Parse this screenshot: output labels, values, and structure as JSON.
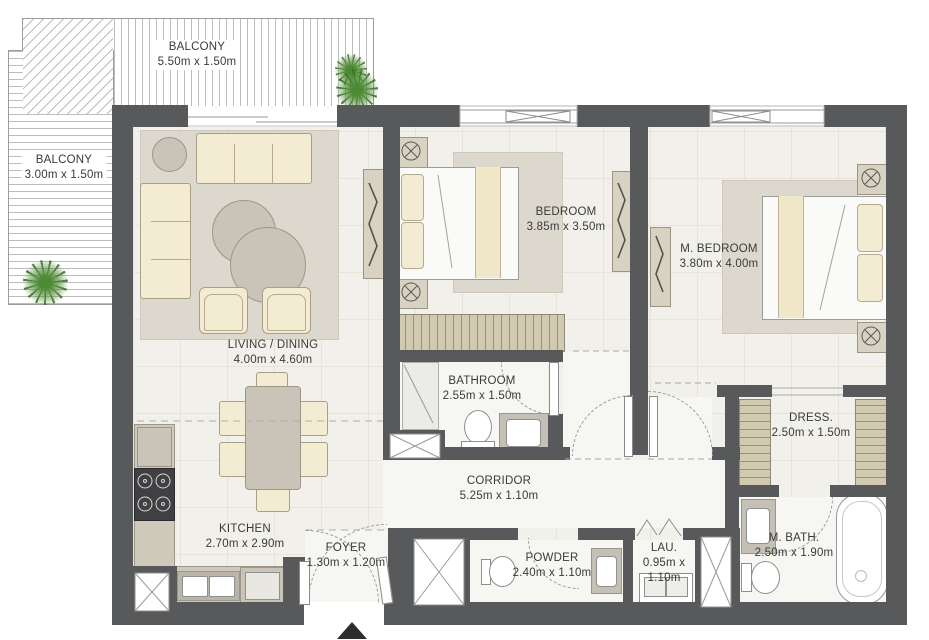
{
  "plan": {
    "colors": {
      "wall": "#58595b",
      "floor": "#f1f0ea",
      "floor_light": "#f6f6f2",
      "rug": "#dcd8ce",
      "furniture_cream": "#f3ecd2",
      "furniture_gray": "#c9c3b8",
      "wardrobe": "#d2cab0",
      "plant": "#4c8a33",
      "line": "#9b9b9b",
      "text": "#3a3a3a"
    },
    "icons": {
      "entrance": "entrance-arrow-up",
      "shaft": "shaft-cross-box",
      "plant": "plant-top-view"
    },
    "rooms": {
      "balcony_top": {
        "name": "BALCONY",
        "dims": "5.50m x 1.50m"
      },
      "balcony_left": {
        "name": "BALCONY",
        "dims": "3.00m x 1.50m"
      },
      "living_dining": {
        "name": "LIVING / DINING",
        "dims": "4.00m x 4.60m"
      },
      "bedroom": {
        "name": "BEDROOM",
        "dims": "3.85m x 3.50m"
      },
      "master_bedroom": {
        "name": "M. BEDROOM",
        "dims": "3.80m x 4.00m"
      },
      "bathroom": {
        "name": "BATHROOM",
        "dims": "2.55m x 1.50m"
      },
      "corridor": {
        "name": "CORRIDOR",
        "dims": "5.25m x 1.10m"
      },
      "dressing": {
        "name": "DRESS.",
        "dims": "2.50m x 1.50m"
      },
      "kitchen": {
        "name": "KITCHEN",
        "dims": "2.70m x 2.90m"
      },
      "foyer": {
        "name": "FOYER",
        "dims": "1.30m x 1.20m"
      },
      "powder": {
        "name": "POWDER",
        "dims": "2.40m x 1.10m"
      },
      "laundry": {
        "name": "LAU.",
        "dims_line1": "0.95m x",
        "dims_line2": "1.10m"
      },
      "master_bath": {
        "name": "M. BATH.",
        "dims": "2.50m x 1.90m"
      }
    }
  }
}
